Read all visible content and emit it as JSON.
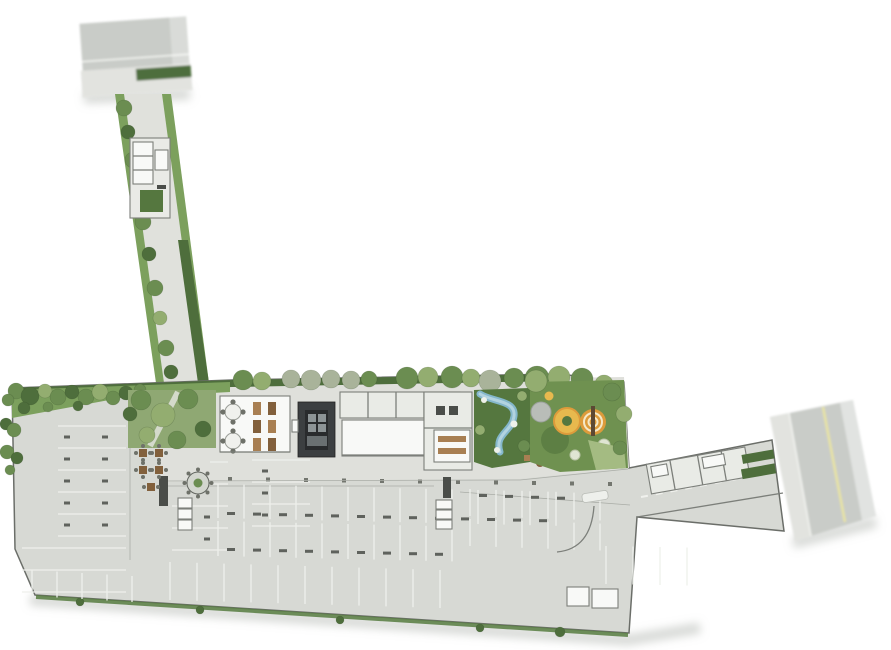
{
  "document": {
    "kind": "architectural-site-plan",
    "description": "Ground floor implantation plan: north street with gated driveway, amenity deck with party room, elevator core, kitchen, water garden and playground, surrounded by striped parking field, east access road to side street",
    "background": "#ffffff"
  },
  "palette": {
    "street": "#c9ccc8",
    "sidewalk": "#e2e3df",
    "curb": "#f4f5f2",
    "body": "#d7d9d4",
    "outline": "#6b6e69",
    "deck": "#dfe0db",
    "drive": "#e0e1dc",
    "room_white": "#f8f9f7",
    "room_gray": "#e9ebe6",
    "wall": "#7c7f7a",
    "wall_dark": "#4a4d49",
    "core": "#3c3f41",
    "core_inner": "#292b2d",
    "stall": "#eef0ec",
    "tick": "#5f625d",
    "hedge": "#4e6e3c",
    "lawn": "#7ca05d",
    "lawn_mid": "#6f9150",
    "lawn_dark": "#55773f",
    "bed": "#8fa873",
    "tree_green": "#6b8d51",
    "tree_light": "#93ad70",
    "tree_gray": "#a9b39a",
    "water": "#84b7cb",
    "water_light": "#b7d6e2",
    "play_yellow": "#e7b94e",
    "play_orange": "#dd9b3b",
    "play_gray": "#b9bdb8",
    "wood": "#a87f52",
    "wood_dark": "#82603c",
    "yellow_line": "#e9e4a2"
  },
  "trees": {
    "top_row": [
      [
        243,
        380,
        10,
        "g"
      ],
      [
        262,
        381,
        9,
        "lg"
      ],
      [
        291,
        379,
        9,
        "gy"
      ],
      [
        311,
        380,
        10,
        "gy"
      ],
      [
        331,
        379,
        9,
        "gy"
      ],
      [
        351,
        380,
        9,
        "gy"
      ],
      [
        369,
        379,
        8,
        "g"
      ],
      [
        407,
        378,
        11,
        "g"
      ],
      [
        428,
        377,
        10,
        "lg"
      ],
      [
        452,
        377,
        11,
        "g"
      ],
      [
        471,
        378,
        9,
        "lg"
      ],
      [
        490,
        381,
        11,
        "gy"
      ],
      [
        514,
        378,
        10,
        "g"
      ],
      [
        537,
        378,
        12,
        "g"
      ],
      [
        559,
        377,
        11,
        "lg"
      ],
      [
        582,
        379,
        11,
        "g"
      ],
      [
        604,
        384,
        9,
        "lg"
      ]
    ],
    "band_bushes": [
      [
        16,
        391,
        8,
        "g"
      ],
      [
        30,
        396,
        9,
        "dg"
      ],
      [
        45,
        391,
        7,
        "lg"
      ],
      [
        58,
        397,
        8,
        "g"
      ],
      [
        72,
        392,
        7,
        "dg"
      ],
      [
        86,
        397,
        8,
        "g"
      ],
      [
        100,
        392,
        8,
        "lg"
      ],
      [
        113,
        398,
        7,
        "g"
      ],
      [
        126,
        393,
        7,
        "dg"
      ],
      [
        140,
        390,
        6,
        "g"
      ],
      [
        24,
        408,
        6,
        "dg"
      ],
      [
        48,
        407,
        5,
        "g"
      ],
      [
        78,
        406,
        5,
        "dg"
      ],
      [
        8,
        400,
        6,
        "g"
      ]
    ],
    "west_edge": [
      [
        6,
        424,
        6,
        "dg"
      ],
      [
        14,
        430,
        7,
        "g"
      ],
      [
        7,
        452,
        7,
        "g"
      ],
      [
        17,
        458,
        6,
        "dg"
      ],
      [
        10,
        470,
        5,
        "g"
      ]
    ],
    "driveway": [
      [
        124,
        108,
        8,
        "g"
      ],
      [
        128,
        132,
        7,
        "dg"
      ],
      [
        133,
        160,
        8,
        "g"
      ],
      [
        138,
        190,
        7,
        "lg"
      ],
      [
        143,
        222,
        8,
        "g"
      ],
      [
        149,
        254,
        7,
        "dg"
      ],
      [
        155,
        288,
        8,
        "g"
      ],
      [
        160,
        318,
        7,
        "lg"
      ],
      [
        166,
        348,
        8,
        "g"
      ],
      [
        171,
        372,
        7,
        "dg"
      ]
    ],
    "garden": [
      [
        141,
        400,
        10,
        "g"
      ],
      [
        163,
        415,
        12,
        "lg"
      ],
      [
        188,
        399,
        10,
        "g"
      ],
      [
        203,
        429,
        8,
        "dg"
      ],
      [
        147,
        435,
        8,
        "lg"
      ],
      [
        177,
        440,
        9,
        "g"
      ],
      [
        130,
        414,
        7,
        "dg"
      ]
    ],
    "playground_edge": [
      [
        536,
        381,
        11,
        "lg"
      ],
      [
        612,
        392,
        9,
        "g"
      ],
      [
        624,
        414,
        8,
        "lg"
      ],
      [
        620,
        448,
        7,
        "g"
      ]
    ],
    "bottom_strip": [
      [
        80,
        602,
        4,
        "dg"
      ],
      [
        200,
        610,
        4,
        "dg"
      ],
      [
        340,
        620,
        4,
        "dg"
      ],
      [
        480,
        628,
        4,
        "dg"
      ],
      [
        560,
        632,
        5,
        "dg"
      ]
    ]
  },
  "parking": {
    "west_a": {
      "orient": "h",
      "x1": 58,
      "x2": 126,
      "y": 426,
      "step": 22,
      "count": 6,
      "tick_x": [
        64,
        102
      ]
    },
    "west_b": {
      "orient": "h",
      "x1": 172,
      "x2": 228,
      "y": 506,
      "step": 22,
      "count": 3,
      "tick_x": [
        204
      ]
    },
    "west_b2": {
      "orient": "h",
      "x1": 210,
      "x2": 228,
      "y": 462,
      "step": 22,
      "count": 2
    },
    "west_c": {
      "orient": "h",
      "x1": 252,
      "x2": 310,
      "y": 460,
      "step": 22,
      "count": 4,
      "tick_x": [
        262
      ]
    },
    "west_d": {
      "orient": "h",
      "x1": 22,
      "x2": 126,
      "y": 548,
      "step": 22,
      "count": 3
    },
    "west_bottom": {
      "orient": "v",
      "x": 32,
      "y1": 570,
      "y2": 596,
      "step": 25,
      "count": 5,
      "skew": 1.5
    },
    "mid_a": {
      "orient": "v",
      "x": 218,
      "y1": 484,
      "y2": 518,
      "step": 26,
      "count": 14,
      "skew": 0.6,
      "tick_y": 512
    },
    "mid_b": {
      "orient": "v",
      "x": 218,
      "y1": 521,
      "y2": 556,
      "step": 26,
      "count": 10,
      "skew": 0.6,
      "tick_y": 548
    },
    "mid_c": {
      "orient": "v",
      "x": 170,
      "y1": 562,
      "y2": 600,
      "step": 27,
      "count": 11,
      "skew": 0.8
    },
    "right_a": {
      "orient": "v",
      "x": 470,
      "y1": 489,
      "y2": 516,
      "step": 26,
      "count": 6,
      "skew": 0.9,
      "tick_y": 494
    },
    "right_b": {
      "orient": "v",
      "x": 470,
      "y1": 519,
      "y2": 546,
      "step": 26,
      "count": 6,
      "skew": 0.9
    },
    "right_se": {
      "orient": "v",
      "x": 606,
      "y1": 546,
      "y2": 584,
      "step": 27,
      "count": 4,
      "skew": 0.5
    },
    "col_dots": {
      "orient": "dots",
      "x": 228,
      "y": 477,
      "step": 38,
      "count": 11,
      "skew": 0.5
    }
  }
}
